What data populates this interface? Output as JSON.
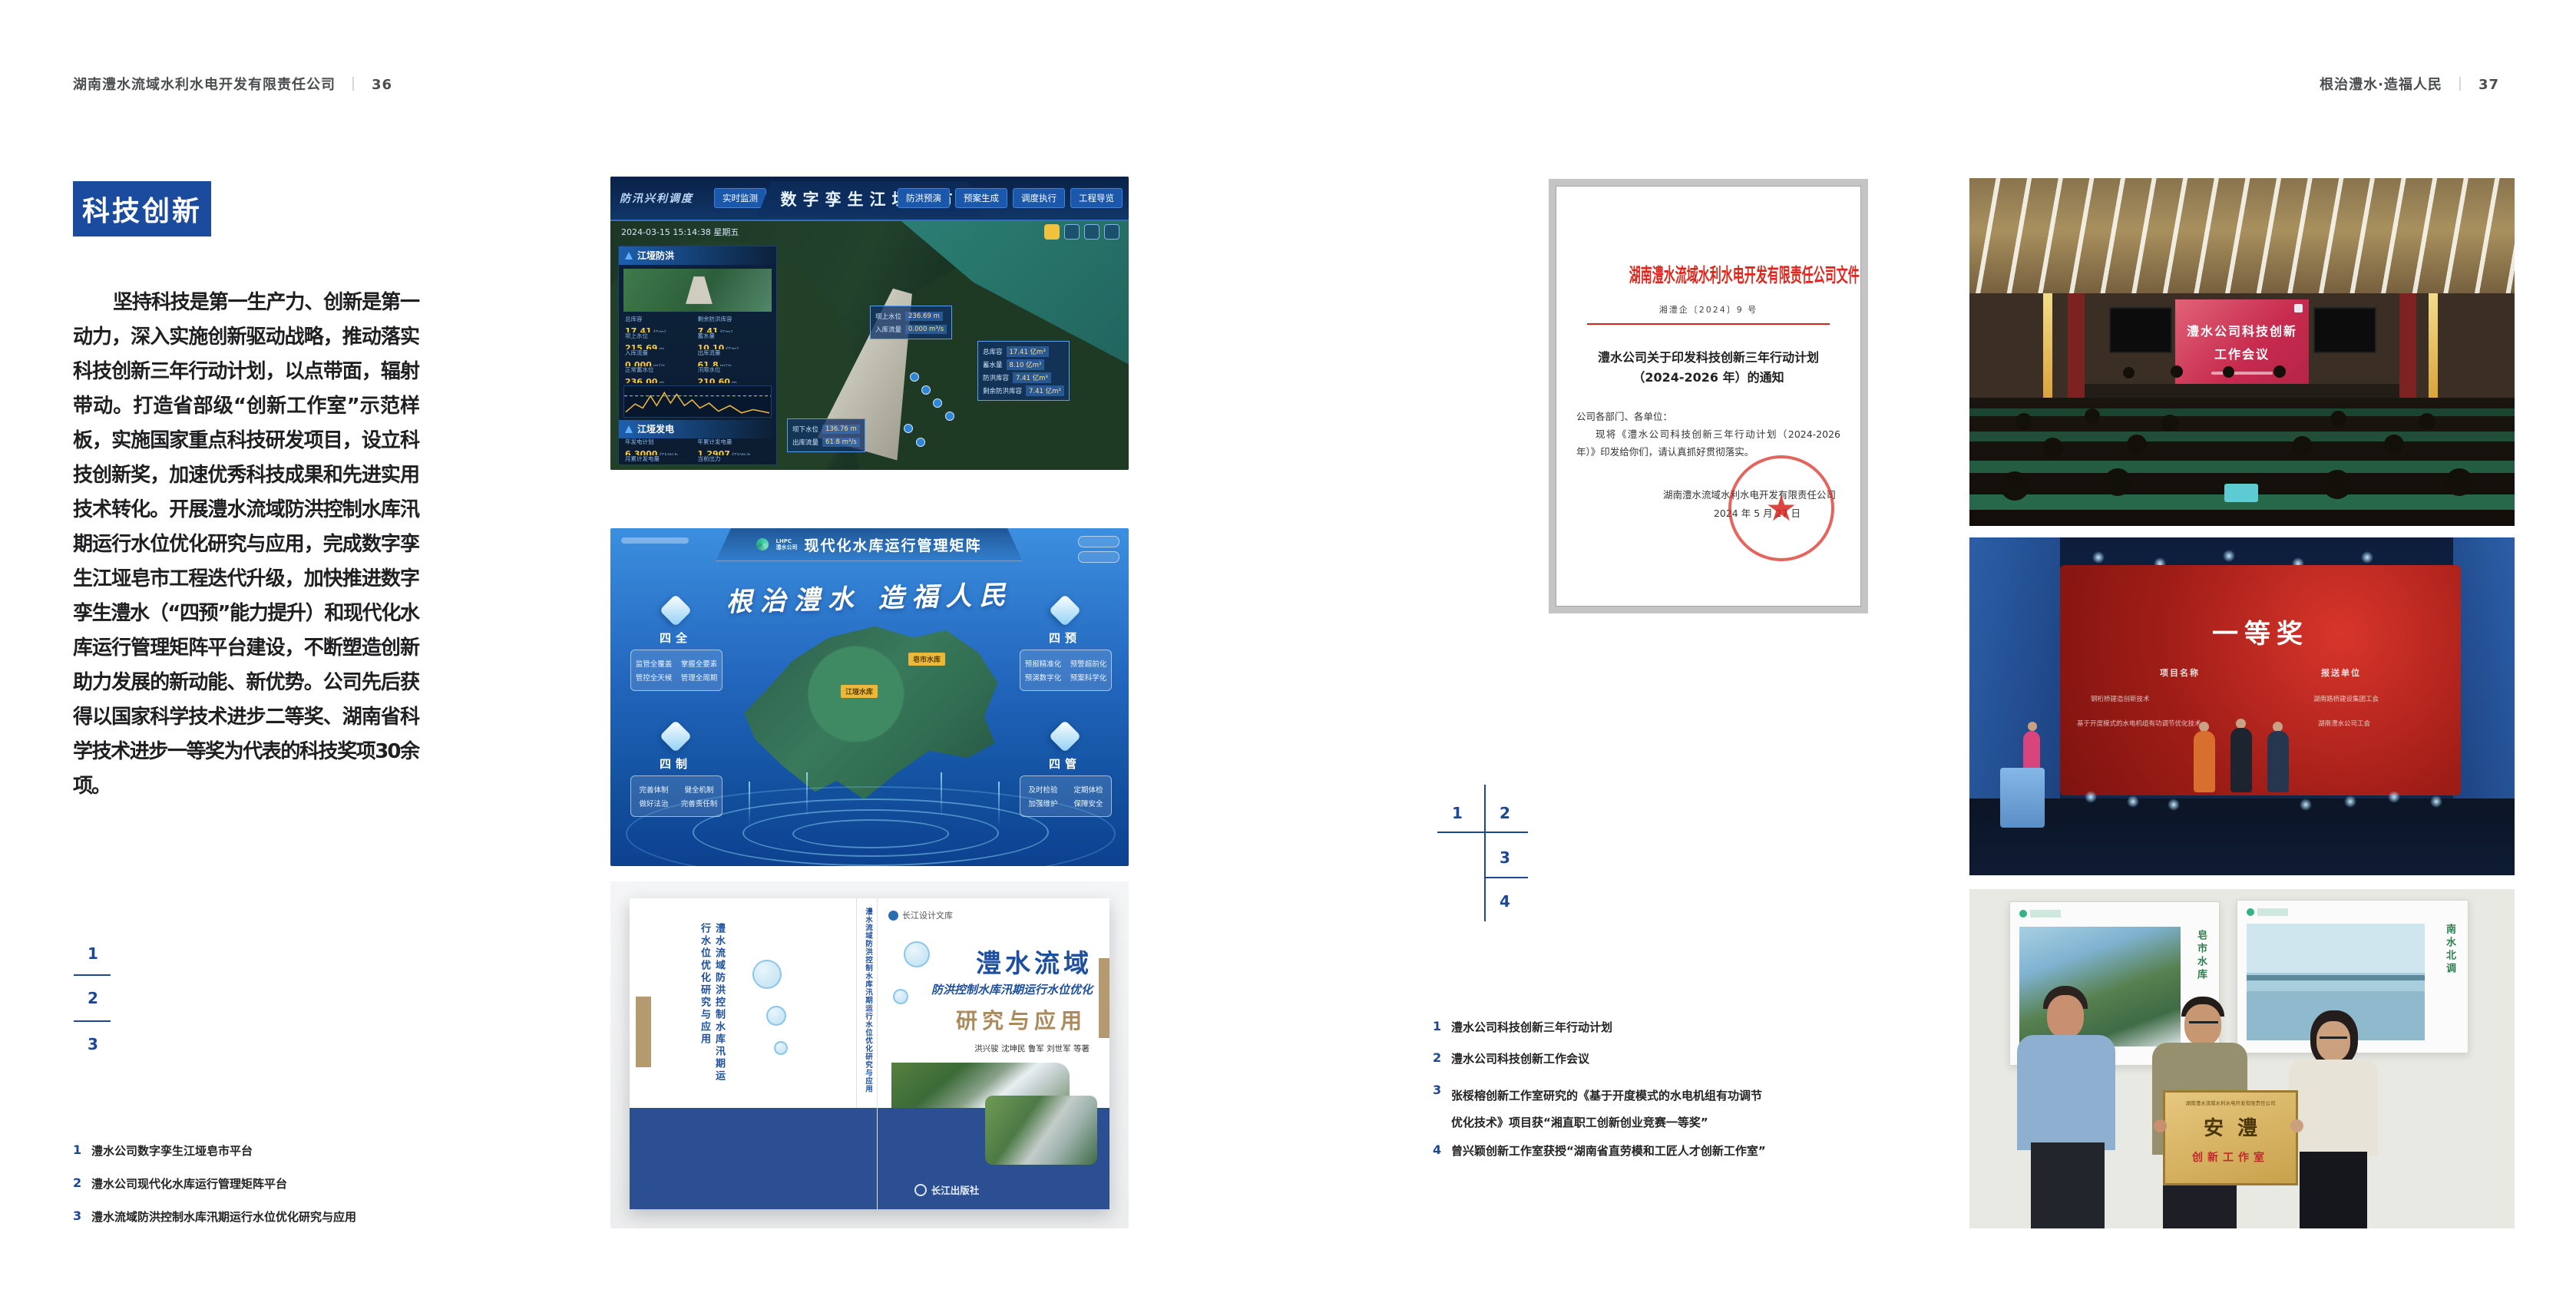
{
  "colors": {
    "accent_blue": "#1a4b9f",
    "marker_blue": "#1c4796",
    "doc_red": "#d9251c",
    "band_blue": "#2c4f93"
  },
  "page_left": {
    "header": {
      "title": "湖南澧水流域水利水电开发有限责任公司",
      "divider": "｜",
      "page_no": "36"
    },
    "section_badge": "科技创新",
    "paragraph": "坚持科技是第一生产力、创新是第一动力，深入实施创新驱动战略，推动落实科技创新三年行动计划，以点带面，辐射带动。打造省部级“创新工作室”示范样板，实施国家重点科技研发项目，设立科技创新奖，加速优秀科技成果和先进实用技术转化。开展澧水流域防洪控制水库汛期运行水位优化研究与应用，完成数字孪生江垭皂市工程迭代升级，加快推进数字孪生澧水（“四预”能力提升）和现代化水库运行管理矩阵平台建设，不断塑造创新助力发展的新动能、新优势。公司先后获得以国家科学技术进步二等奖、湖南省科学技术进步一等奖为代表的科技奖项30余项。",
    "markers": [
      "1",
      "2",
      "3"
    ],
    "captions": [
      {
        "no": "1",
        "text": "澧水公司数字孪生江垭皂市平台"
      },
      {
        "no": "2",
        "text": "澧水公司现代化水库运行管理矩阵平台"
      },
      {
        "no": "3",
        "text": "澧水流域防洪控制水库汛期运行水位优化研究与应用"
      }
    ],
    "fig_twin": {
      "title": "数字孪生江垭皂市",
      "corner_label": "防汛兴利调度",
      "nav_left": [
        "实时监测",
        "洪水预报",
        "防洪预警"
      ],
      "nav_right": [
        "防洪预演",
        "预案生成",
        "调度执行",
        "工程导览"
      ],
      "datetime": "2024-03-15 15:14:38 星期五",
      "panel_flood_title": "江垭防洪",
      "flood_stats": [
        {
          "label": "总库容",
          "value": "17.41",
          "unit": "亿m³"
        },
        {
          "label": "剩余防洪库容",
          "value": "7.41",
          "unit": "亿m³"
        },
        {
          "label": "坝上水位",
          "value": "215.69",
          "unit": "m"
        },
        {
          "label": "蓄水量",
          "value": "10.10",
          "unit": "亿m³"
        },
        {
          "label": "入库流量",
          "value": "0.000",
          "unit": "m³/s"
        },
        {
          "label": "出库流量",
          "value": "61.8",
          "unit": "m³/s"
        },
        {
          "label": "正常蓄水位",
          "value": "236.00",
          "unit": "m"
        },
        {
          "label": "汛限水位",
          "value": "210.60",
          "unit": "m"
        }
      ],
      "panel_power_title": "江垭发电",
      "power_stats": [
        {
          "label": "年发电计划",
          "value": "6.3000",
          "unit": "亿kW·h"
        },
        {
          "label": "年累计发电量",
          "value": "1.2907",
          "unit": "亿kW·h"
        },
        {
          "label": "月累计发电量",
          "value": "3259.21",
          "unit": "万kW·h"
        },
        {
          "label": "当前出力",
          "value": "0.00",
          "unit": "MW"
        }
      ],
      "gauges": [
        "1号机组",
        "2号机组",
        "3号机组"
      ],
      "tooltip_up": [
        {
          "label": "坝上水位",
          "value": "236.69 m"
        },
        {
          "label": "入库流量",
          "value": "0.000 m³/s"
        }
      ],
      "tooltip_res": [
        {
          "label": "总库容",
          "value": "17.41 亿m³"
        },
        {
          "label": "蓄水量",
          "value": "8.10 亿m³"
        },
        {
          "label": "防洪库容",
          "value": "7.41 亿m³"
        },
        {
          "label": "剩余防洪库容",
          "value": "7.41 亿m³"
        }
      ],
      "tooltip_down": [
        {
          "label": "坝下水位",
          "value": "136.76 m"
        },
        {
          "label": "出库流量",
          "value": "61.8 m³/s"
        }
      ]
    },
    "fig_matrix": {
      "logo_abbr": "LHPC",
      "logo_name": "澧水公司",
      "title": "现代化水库运行管理矩阵",
      "slogan": "根治澧水 造福人民",
      "groups": [
        {
          "name": "四全",
          "items": [
            "监管全覆盖",
            "掌握全要素",
            "管控全天候",
            "管理全周期"
          ]
        },
        {
          "name": "四预",
          "items": [
            "预报精准化",
            "预警超前化",
            "预演数字化",
            "预案科学化"
          ]
        },
        {
          "name": "四制",
          "items": [
            "完善体制",
            "健全机制",
            "做好法治",
            "完善责任制"
          ]
        },
        {
          "name": "四管",
          "items": [
            "及时检验",
            "定期体检",
            "加强维护",
            "保障安全"
          ]
        }
      ],
      "map_tags": [
        "皂市水库",
        "江垭水库"
      ]
    },
    "fig_book": {
      "series": "长江设计文库",
      "title_region": "澧水流域",
      "title_sub": "防洪控制水库汛期运行水位优化",
      "title_tail": "研究与应用",
      "authors": "洪兴骏 沈坤民 鲁军 刘世军 等著",
      "publisher": "长江出版社",
      "spine_text": "澧水流域防洪控制水库汛期运行水位优化研究与应用"
    }
  },
  "page_right": {
    "header": {
      "title": "根治澧水·造福人民",
      "divider": "｜",
      "page_no": "37"
    },
    "document": {
      "masthead": "湖南澧水流域水利水电开发有限责任公司文件",
      "doc_no": "湘澧企〔2024〕9 号",
      "title": "澧水公司关于印发科技创新三年行动计划（2024-2026 年）的通知",
      "salutation": "公司各部门、各单位：",
      "body": "现将《澧水公司科技创新三年行动计划（2024-2026 年）》印发给你们，请认真抓好贯彻落实。",
      "signer": "湖南澧水流域水利水电开发有限责任公司",
      "date": "2024 年 5 月 27 日"
    },
    "markers": [
      "1",
      "2",
      "3",
      "4"
    ],
    "captions": [
      {
        "no": "1",
        "text": "澧水公司科技创新三年行动计划"
      },
      {
        "no": "2",
        "text": "澧水公司科技创新工作会议"
      },
      {
        "no": "3",
        "text": "张桵榕创新工作室研究的《基于开度模式的水电机组有功调节优化技术》项目获“湘直职工创新创业竞赛一等奖”"
      },
      {
        "no": "4",
        "text": "曾兴颖创新工作室获授“湖南省直劳模和工匠人才创新工作室”"
      }
    ],
    "photo_meeting": {
      "screen_line1": "澧水公司科技创新",
      "screen_line2": "工作会议"
    },
    "photo_award": {
      "headline": "一等奖",
      "col_project": "项目名称",
      "col_unit": "报送单位",
      "rows": [
        {
          "project": "钢桁桥建造创新技术",
          "unit": "湖南路桥建设集团工会"
        },
        {
          "project": "基于开度模式的水电机组有功调节优化技术",
          "unit": "湖南澧水公司工会"
        }
      ]
    },
    "photo_plaque": {
      "org_line": "湖南澧水流域水利水电开发有限责任公司",
      "plaque_main": "安澧",
      "plaque_sub": "创新工作室",
      "poster_left_caption": "皂市水库",
      "poster_right_caption": "南水北调"
    }
  }
}
